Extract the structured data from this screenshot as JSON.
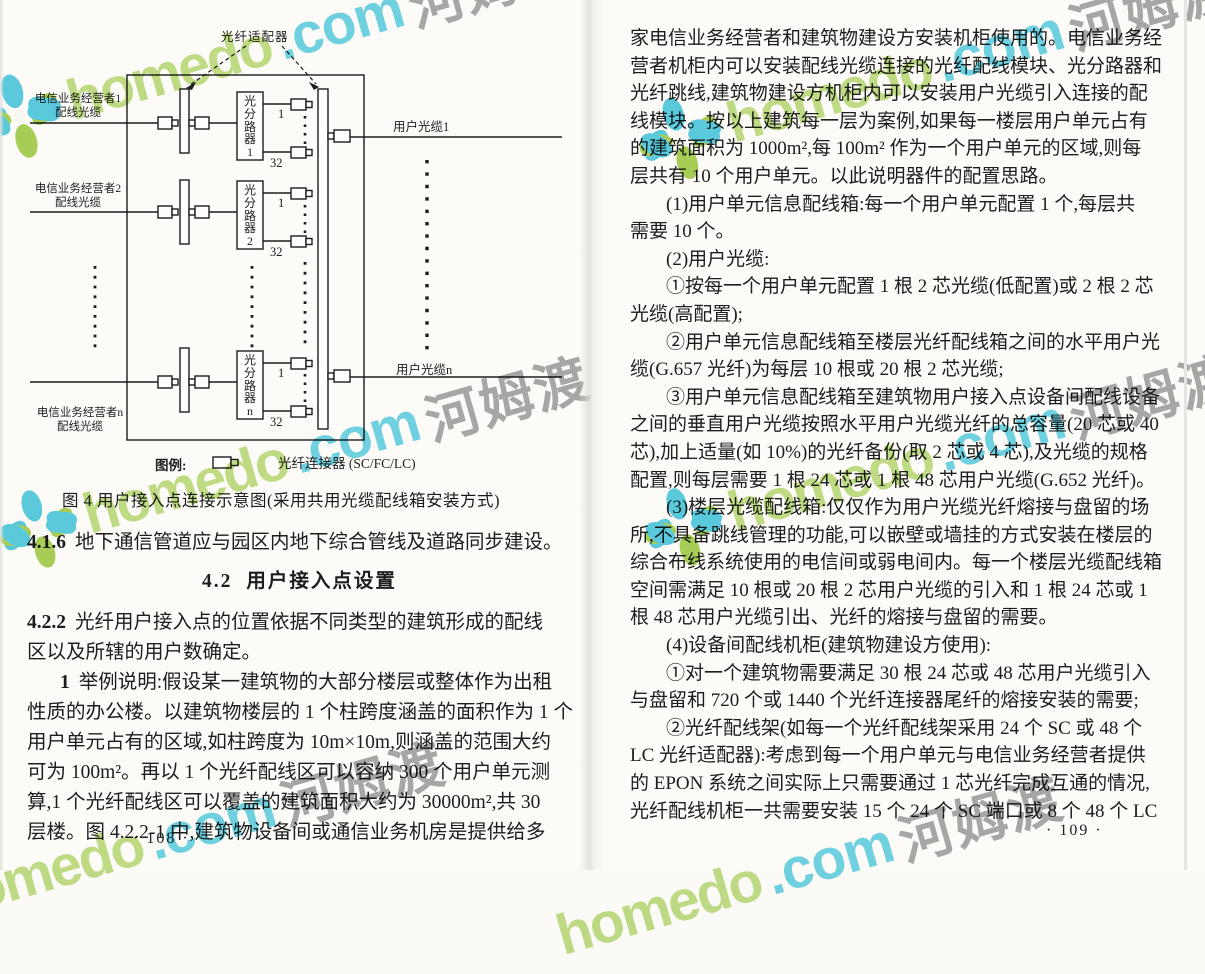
{
  "watermark": {
    "brand": "homedo",
    "tld": ".com",
    "cjk": "河姆渡",
    "color_green": "#9bc93d",
    "color_cyan": "#40c5de",
    "color_gray": "#949494"
  },
  "figure": {
    "adapter_label": "光纤适配器",
    "rows": [
      {
        "op_line1": "电信业务经营者1",
        "op_line2": "配线光缆",
        "splitter": "光分路器1",
        "p_top": "1",
        "p_bot": "32"
      },
      {
        "op_line1": "电信业务经营者2",
        "op_line2": "配线光缆",
        "splitter": "光分路器2",
        "p_top": "1",
        "p_bot": "32"
      },
      {
        "op_line1": "电信业务经营者n",
        "op_line2": "配线光缆",
        "splitter": "光分路器n",
        "p_top": "1",
        "p_bot": "32"
      }
    ],
    "out_top": "用户光缆1",
    "out_bottom": "用户光缆n",
    "legend_label": "图例:",
    "legend_item": "光纤连接器 (SC/FC/LC)",
    "caption": "图 4  用户接入点连接示意图(采用共用光缆配线箱安装方式)"
  },
  "left_page": {
    "lines": [
      {
        "b": "4.1.6",
        "t": "地下通信管道应与园区内地下综合管线及道路同步建设。",
        "cls": "sec"
      },
      {
        "b": "4.2",
        "t": "用户接入点设置",
        "cls": "heading"
      },
      {
        "b": "4.2.2",
        "t": "光纤用户接入点的位置依据不同类型的建筑形成的配线",
        "cls": "sec"
      },
      {
        "b": "",
        "t": "区以及所辖的用户数确定。",
        "cls": ""
      },
      {
        "b": "1",
        "t": "举例说明:假设某一建筑物的大部分楼层或整体作为出租",
        "cls": "indent"
      },
      {
        "b": "",
        "t": "性质的办公楼。以建筑物楼层的 1 个柱跨度涵盖的面积作为 1 个",
        "cls": ""
      },
      {
        "b": "",
        "t": "用户单元占有的区域,如柱跨度为 10m×10m,则涵盖的范围大约",
        "cls": ""
      },
      {
        "b": "",
        "t": "可为 100m²。再以 1 个光纤配线区可以容纳 300 个用户单元测",
        "cls": ""
      },
      {
        "b": "",
        "t": "算,1 个光纤配线区可以覆盖的建筑面积大约为 30000m²,共 30",
        "cls": ""
      },
      {
        "b": "",
        "t": "层楼。图 4.2.2-1 中,建筑物设备间或通信业务机房是提供给多",
        "cls": ""
      }
    ],
    "page_number": "· 108 ·"
  },
  "right_page": {
    "lines": [
      {
        "t": "家电信业务经营者和建筑物建设方安装机柜使用的。电信业务经",
        "cls": ""
      },
      {
        "t": "营者机柜内可以安装配线光缆连接的光纤配线模块、光分路器和",
        "cls": ""
      },
      {
        "t": "光纤跳线,建筑物建设方机柜内可以安装用户光缆引入连接的配",
        "cls": ""
      },
      {
        "t": "线模块。按以上建筑每一层为案例,如果每一楼层用户单元占有",
        "cls": ""
      },
      {
        "t": "的建筑面积为 1000m²,每 100m² 作为一个用户单元的区域,则每",
        "cls": ""
      },
      {
        "t": "层共有 10 个用户单元。以此说明器件的配置思路。",
        "cls": ""
      },
      {
        "t": "(1)用户单元信息配线箱:每一个用户单元配置 1 个,每层共",
        "cls": "indent"
      },
      {
        "t": "需要 10 个。",
        "cls": ""
      },
      {
        "t": "(2)用户光缆:",
        "cls": "indent"
      },
      {
        "t": "①按每一个用户单元配置 1 根 2 芯光缆(低配置)或 2 根 2 芯",
        "cls": "indent"
      },
      {
        "t": "光缆(高配置);",
        "cls": ""
      },
      {
        "t": "②用户单元信息配线箱至楼层光纤配线箱之间的水平用户光",
        "cls": "indent"
      },
      {
        "t": "缆(G.657 光纤)为每层 10 根或 20 根 2 芯光缆;",
        "cls": ""
      },
      {
        "t": "③用户单元信息配线箱至建筑物用户接入点设备间配线设备",
        "cls": "indent"
      },
      {
        "t": "之间的垂直用户光缆按照水平用户光缆光纤的总容量(20 芯或 40",
        "cls": ""
      },
      {
        "t": "芯),加上适量(如 10%)的光纤备份(取 2 芯或 4 芯),及光缆的规格",
        "cls": ""
      },
      {
        "t": "配置,则每层需要 1 根 24 芯或 1 根 48 芯用户光缆(G.652 光纤)。",
        "cls": ""
      },
      {
        "t": "(3)楼层光缆配线箱:仅仅作为用户光缆光纤熔接与盘留的场",
        "cls": "indent"
      },
      {
        "t": "所,不具备跳线管理的功能,可以嵌壁或墙挂的方式安装在楼层的",
        "cls": ""
      },
      {
        "t": "综合布线系统使用的电信间或弱电间内。每一个楼层光缆配线箱",
        "cls": ""
      },
      {
        "t": "空间需满足 10 根或 20 根 2 芯用户光缆的引入和 1 根 24 芯或 1",
        "cls": ""
      },
      {
        "t": "根 48 芯用户光缆引出、光纤的熔接与盘留的需要。",
        "cls": ""
      },
      {
        "t": "(4)设备间配线机柜(建筑物建设方使用):",
        "cls": "indent"
      },
      {
        "t": "①对一个建筑物需要满足 30 根 24 芯或 48 芯用户光缆引入",
        "cls": "indent"
      },
      {
        "t": "与盘留和 720 个或 1440 个光纤连接器尾纤的熔接安装的需要;",
        "cls": ""
      },
      {
        "t": "②光纤配线架(如每一个光纤配线架采用 24 个 SC 或 48 个",
        "cls": "indent"
      },
      {
        "t": "LC 光纤适配器):考虑到每一个用户单元与电信业务经营者提供",
        "cls": ""
      },
      {
        "t": "的 EPON 系统之间实际上只需要通过 1 芯光纤完成互通的情况,",
        "cls": ""
      },
      {
        "t": "光纤配线机柜一共需要安装 15 个 24 个 SC 端口或 8 个 48 个 LC",
        "cls": ""
      }
    ],
    "page_number": "· 109 ·"
  }
}
